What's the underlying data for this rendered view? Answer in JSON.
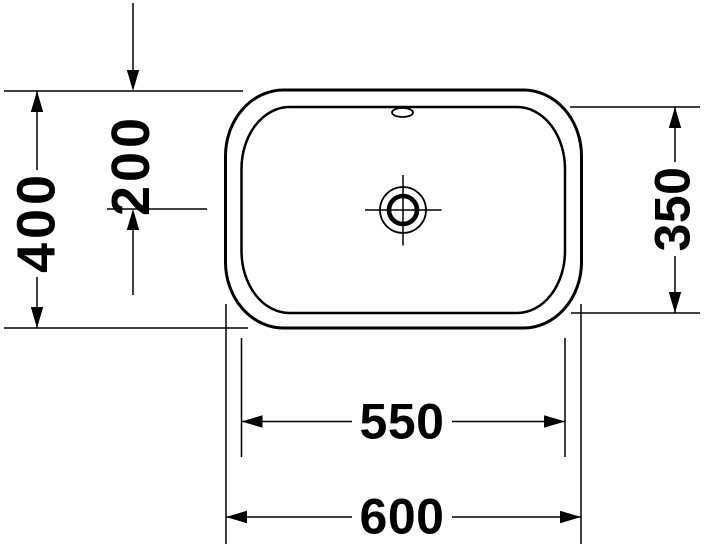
{
  "drawing": {
    "subject": "washbasin-top-view-technical-drawing",
    "background_color": "#ffffff",
    "line_color": "#000000",
    "dims": {
      "overall_width": "600",
      "basin_width": "550",
      "overall_depth": "400",
      "basin_depth": "350",
      "drain_offset": "200"
    }
  }
}
